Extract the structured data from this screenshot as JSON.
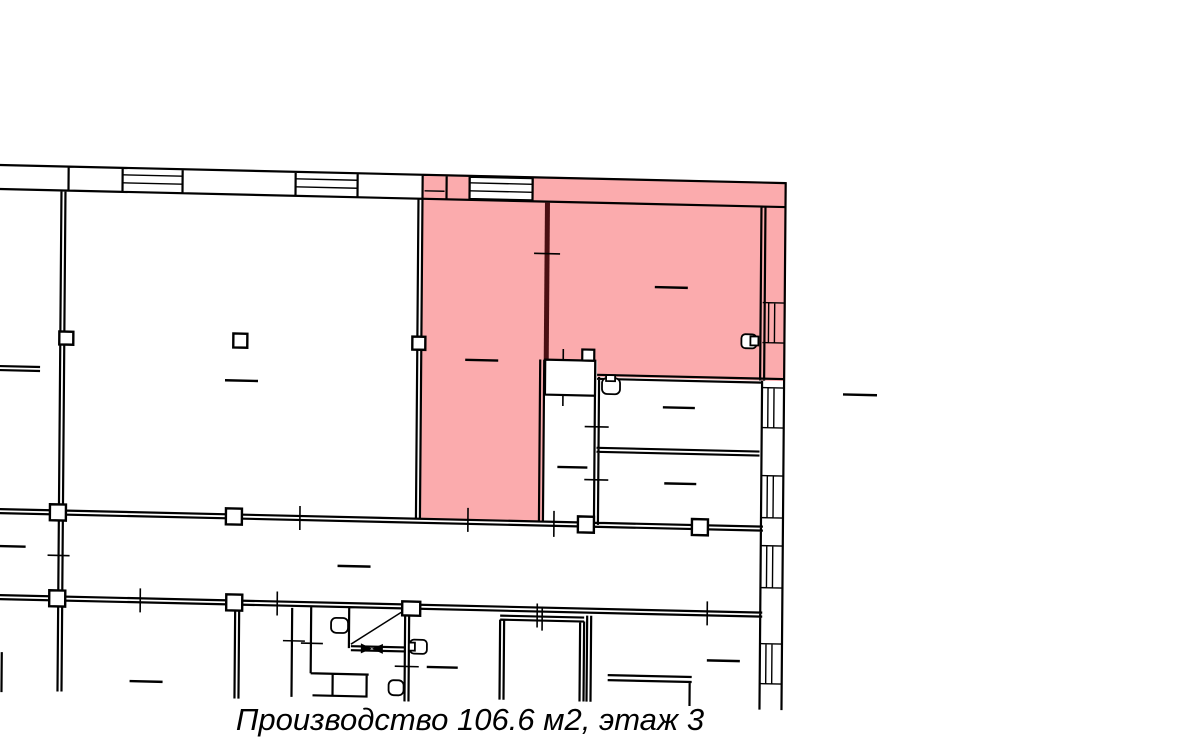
{
  "page": {
    "width_px": 1200,
    "height_px": 745,
    "background_color": "#ffffff"
  },
  "plan": {
    "caption": "Производство 106.6 м2, этаж 3",
    "usage_label": "Производство",
    "area_m2": "106.6",
    "floor": "3",
    "highlight_color": "#fbabad",
    "wall_color": "#000000",
    "highlight_divider_color": "#4a0e12",
    "room_fill_color": "#ffffff"
  }
}
